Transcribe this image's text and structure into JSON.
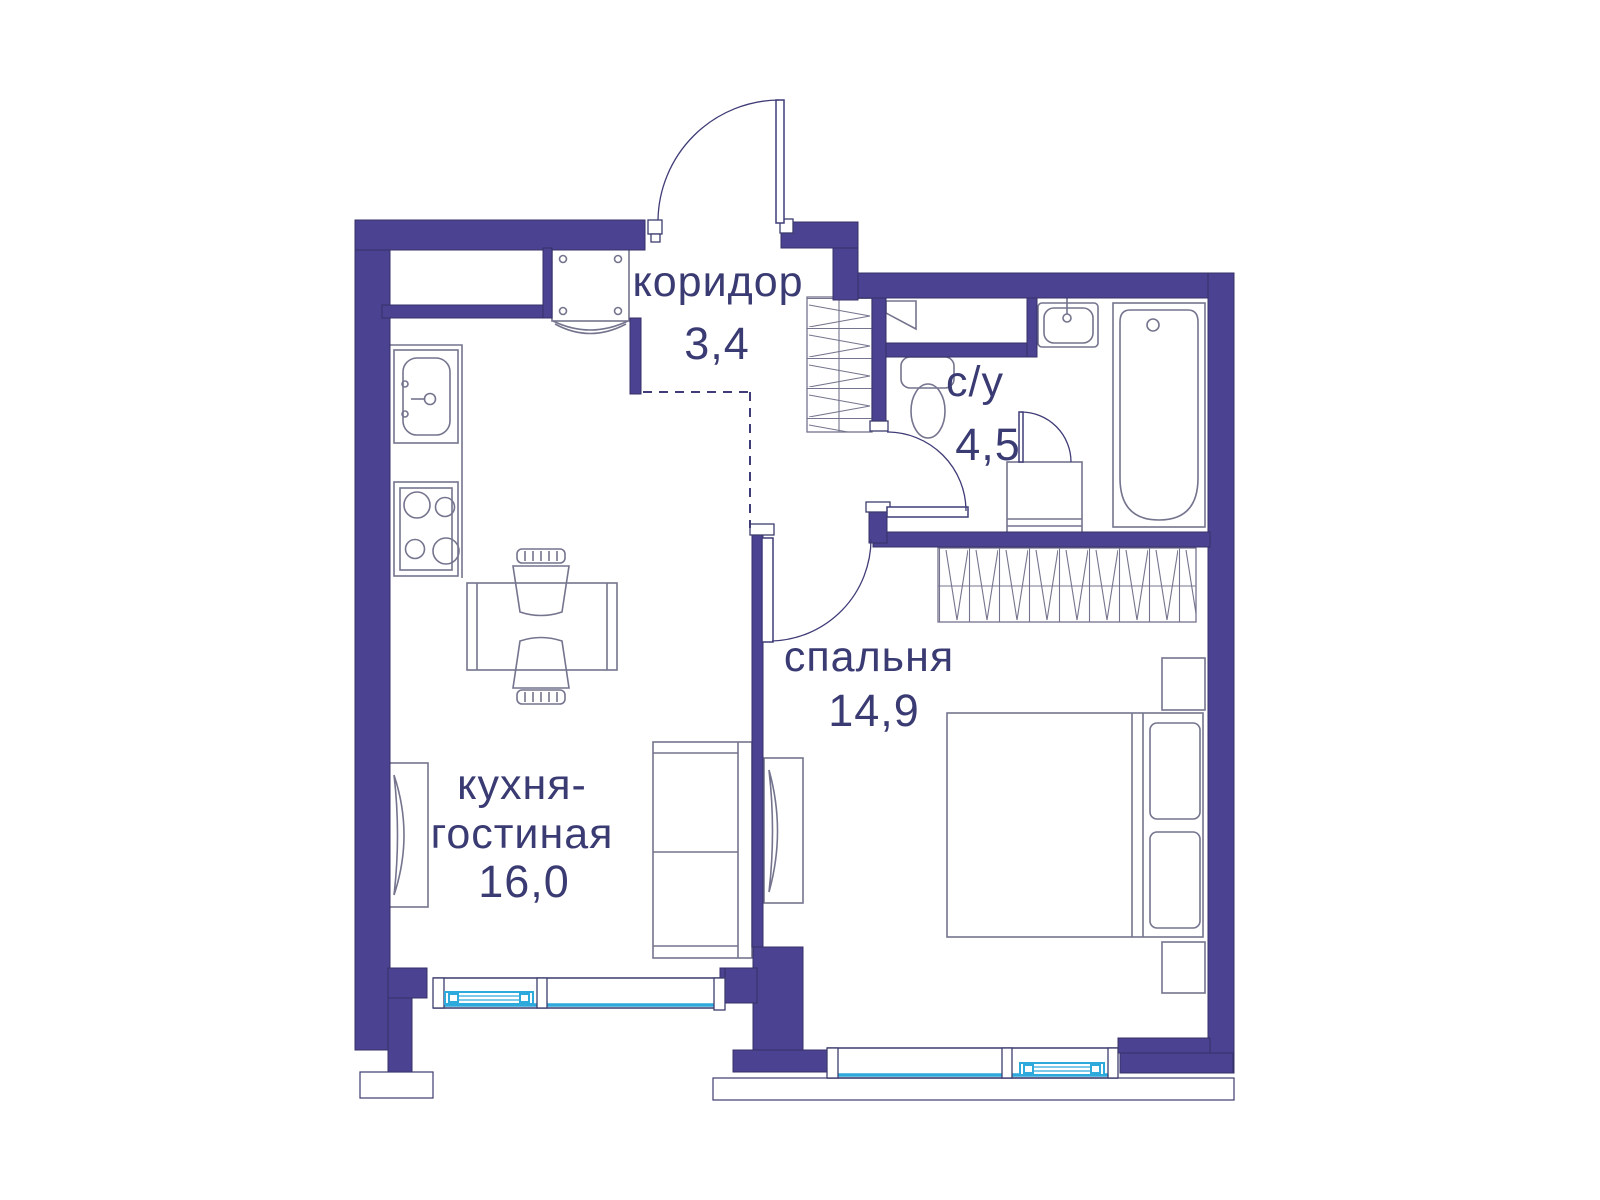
{
  "plan": {
    "type": "apartment-floor-plan",
    "rooms": {
      "corridor": {
        "label": "коридор",
        "area": "3,4"
      },
      "bathroom": {
        "label": "с/у",
        "area": "4,5"
      },
      "bedroom": {
        "label": "спальня",
        "area": "14,9"
      },
      "kitchen_living": {
        "label_line1": "кухня-",
        "label_line2": "гостиная",
        "area": "16,0"
      }
    },
    "colors": {
      "wall": "#4b4291",
      "wall_outline": "#343168",
      "label_text": "#3b3b74",
      "window_glass": "#2ea9dc",
      "furniture_line": "#74748e",
      "door_line": "#3f3c77",
      "background": "#ffffff"
    }
  }
}
